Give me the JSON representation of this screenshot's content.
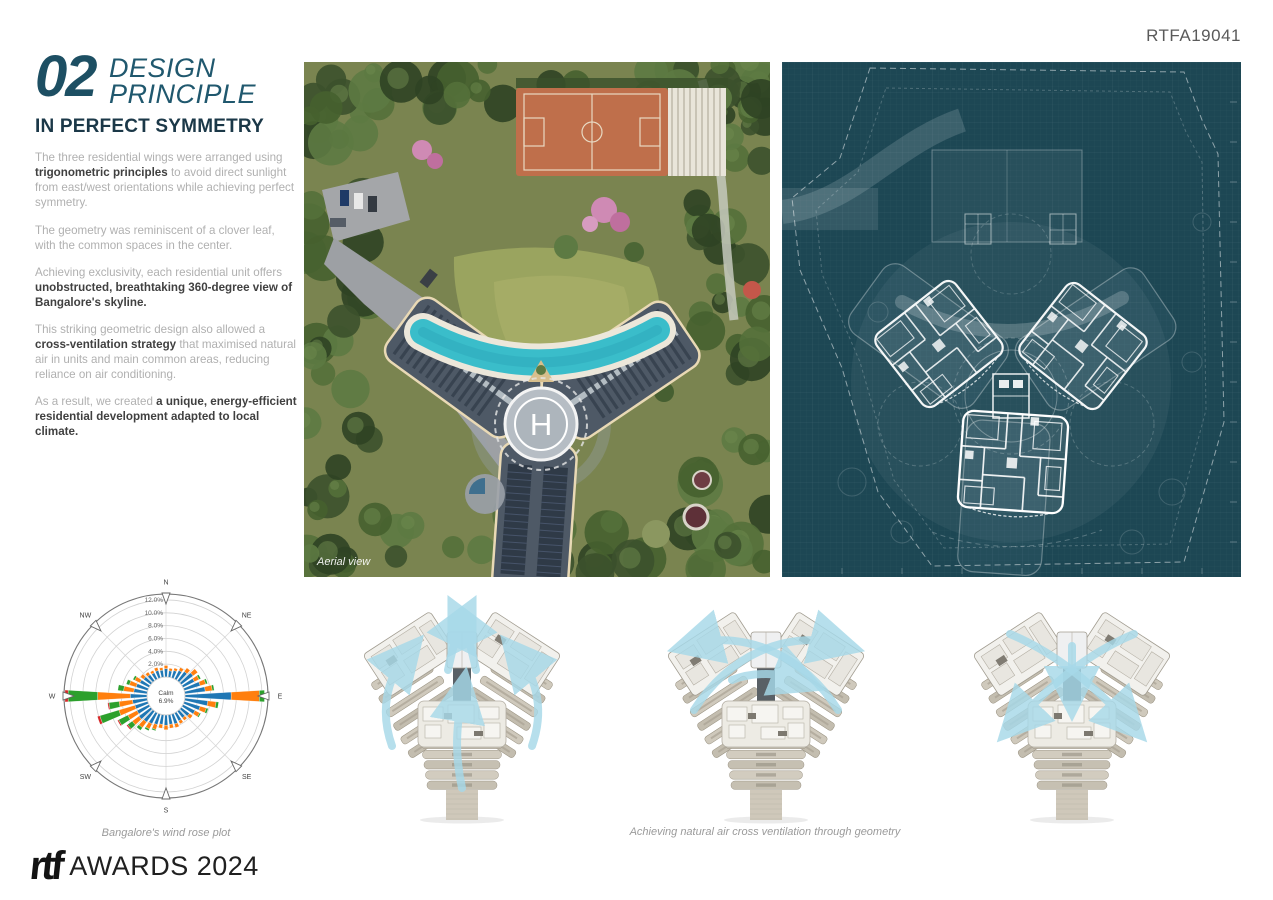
{
  "header": {
    "code": "RTFA19041"
  },
  "section": {
    "number": "02",
    "title_lines": [
      "DESIGN",
      "PRINCIPLE"
    ],
    "subtitle": "IN PERFECT SYMMETRY",
    "paragraphs": [
      {
        "segments": [
          {
            "text": "The three residential wings were arranged using ",
            "bold": false
          },
          {
            "text": "trigonometric principles",
            "bold": true
          },
          {
            "text": " to avoid direct sunlight from east/west orientations while achieving perfect symmetry.",
            "bold": false
          }
        ]
      },
      {
        "segments": [
          {
            "text": "The geometry was reminiscent of a clover leaf, with the common spaces in the center.",
            "bold": false
          }
        ]
      },
      {
        "segments": [
          {
            "text": "Achieving exclusivity, each residential unit offers ",
            "bold": false
          },
          {
            "text": "unobstructed, breathtaking 360-degree view of Bangalore's skyline.",
            "bold": true
          }
        ]
      },
      {
        "segments": [
          {
            "text": "This striking geometric design also allowed a ",
            "bold": false
          },
          {
            "text": "cross-ventilation strategy",
            "bold": true
          },
          {
            "text": " that maximised natural air in units and main common areas, reducing reliance on air conditioning.",
            "bold": false
          }
        ]
      },
      {
        "segments": [
          {
            "text": "As a result, we created ",
            "bold": false
          },
          {
            "text": "a unique, energy-efficient residential development adapted to local climate.",
            "bold": true
          }
        ]
      }
    ]
  },
  "aerial": {
    "caption": "Aerial view",
    "helipad_letter": "H"
  },
  "wind_rose": {
    "caption": "Bangalore's wind rose plot"
  },
  "ventilation": {
    "caption": "Achieving natural air cross ventilation through geometry",
    "variants": [
      "updraft",
      "cross-flow",
      "converging"
    ]
  },
  "footer": {
    "logo": "rtf",
    "title": "AWARDS 2024"
  },
  "chart_data": {
    "type": "windrose-stacked-polar-bar",
    "title": "Bangalore's wind rose plot",
    "compass_labels": [
      "N",
      "NE",
      "E",
      "SE",
      "S",
      "SW",
      "W",
      "NW"
    ],
    "ring_ticks_percent": [
      2,
      4,
      6,
      8,
      10,
      12
    ],
    "ring_tick_labels": [
      "2.0%",
      "4.0%",
      "6.0%",
      "8.0%",
      "10.0%",
      "12.0%"
    ],
    "calm_label_lines": [
      "Calm",
      "6.9%"
    ],
    "calm_percent": 6.9,
    "stack_colors": [
      "#1f77b4",
      "#ff7f0e",
      "#2ca02c",
      "#d62728"
    ],
    "directions_deg": [
      0,
      10,
      20,
      30,
      40,
      50,
      60,
      70,
      80,
      90,
      100,
      110,
      120,
      130,
      140,
      150,
      160,
      170,
      180,
      190,
      200,
      210,
      220,
      230,
      240,
      250,
      260,
      270,
      280,
      290,
      300,
      310,
      320,
      330,
      340,
      350
    ],
    "stacks_percent": [
      [
        1.3,
        0.5,
        0,
        0
      ],
      [
        1.0,
        0.4,
        0,
        0
      ],
      [
        1.2,
        0.4,
        0,
        0
      ],
      [
        1.5,
        0.5,
        0,
        0
      ],
      [
        1.8,
        0.7,
        0,
        0
      ],
      [
        2.3,
        0.9,
        0,
        0
      ],
      [
        2.0,
        0.8,
        0.3,
        0
      ],
      [
        2.6,
        0.9,
        0.3,
        0
      ],
      [
        3.2,
        1.1,
        0.3,
        0
      ],
      [
        7.2,
        4.4,
        0.8,
        0
      ],
      [
        3.6,
        1.3,
        0.4,
        0
      ],
      [
        2.6,
        1.0,
        0.3,
        0
      ],
      [
        2.1,
        0.8,
        0.2,
        0
      ],
      [
        1.6,
        0.6,
        0,
        0
      ],
      [
        1.3,
        0.5,
        0,
        0
      ],
      [
        1.4,
        0.5,
        0,
        0
      ],
      [
        1.6,
        0.6,
        0,
        0
      ],
      [
        1.5,
        0.6,
        0,
        0
      ],
      [
        1.6,
        0.7,
        0,
        0
      ],
      [
        1.5,
        0.6,
        0,
        0
      ],
      [
        1.7,
        0.8,
        0.2,
        0
      ],
      [
        1.9,
        0.9,
        0.3,
        0
      ],
      [
        2.1,
        1.1,
        0.5,
        0
      ],
      [
        2.3,
        1.3,
        0.9,
        0.2
      ],
      [
        2.1,
        1.6,
        1.6,
        0.2
      ],
      [
        2.1,
        2.6,
        3.1,
        0.4
      ],
      [
        2.3,
        2.1,
        1.6,
        0.2
      ],
      [
        2.6,
        5.1,
        4.6,
        0.5
      ],
      [
        2.1,
        1.6,
        0.9,
        0
      ],
      [
        1.9,
        1.1,
        0.5,
        0
      ],
      [
        1.6,
        0.9,
        0.3,
        0
      ],
      [
        1.4,
        0.6,
        0,
        0
      ],
      [
        1.2,
        0.5,
        0,
        0
      ],
      [
        1.1,
        0.4,
        0,
        0
      ],
      [
        1.2,
        0.5,
        0,
        0
      ],
      [
        1.1,
        0.4,
        0,
        0
      ]
    ]
  }
}
